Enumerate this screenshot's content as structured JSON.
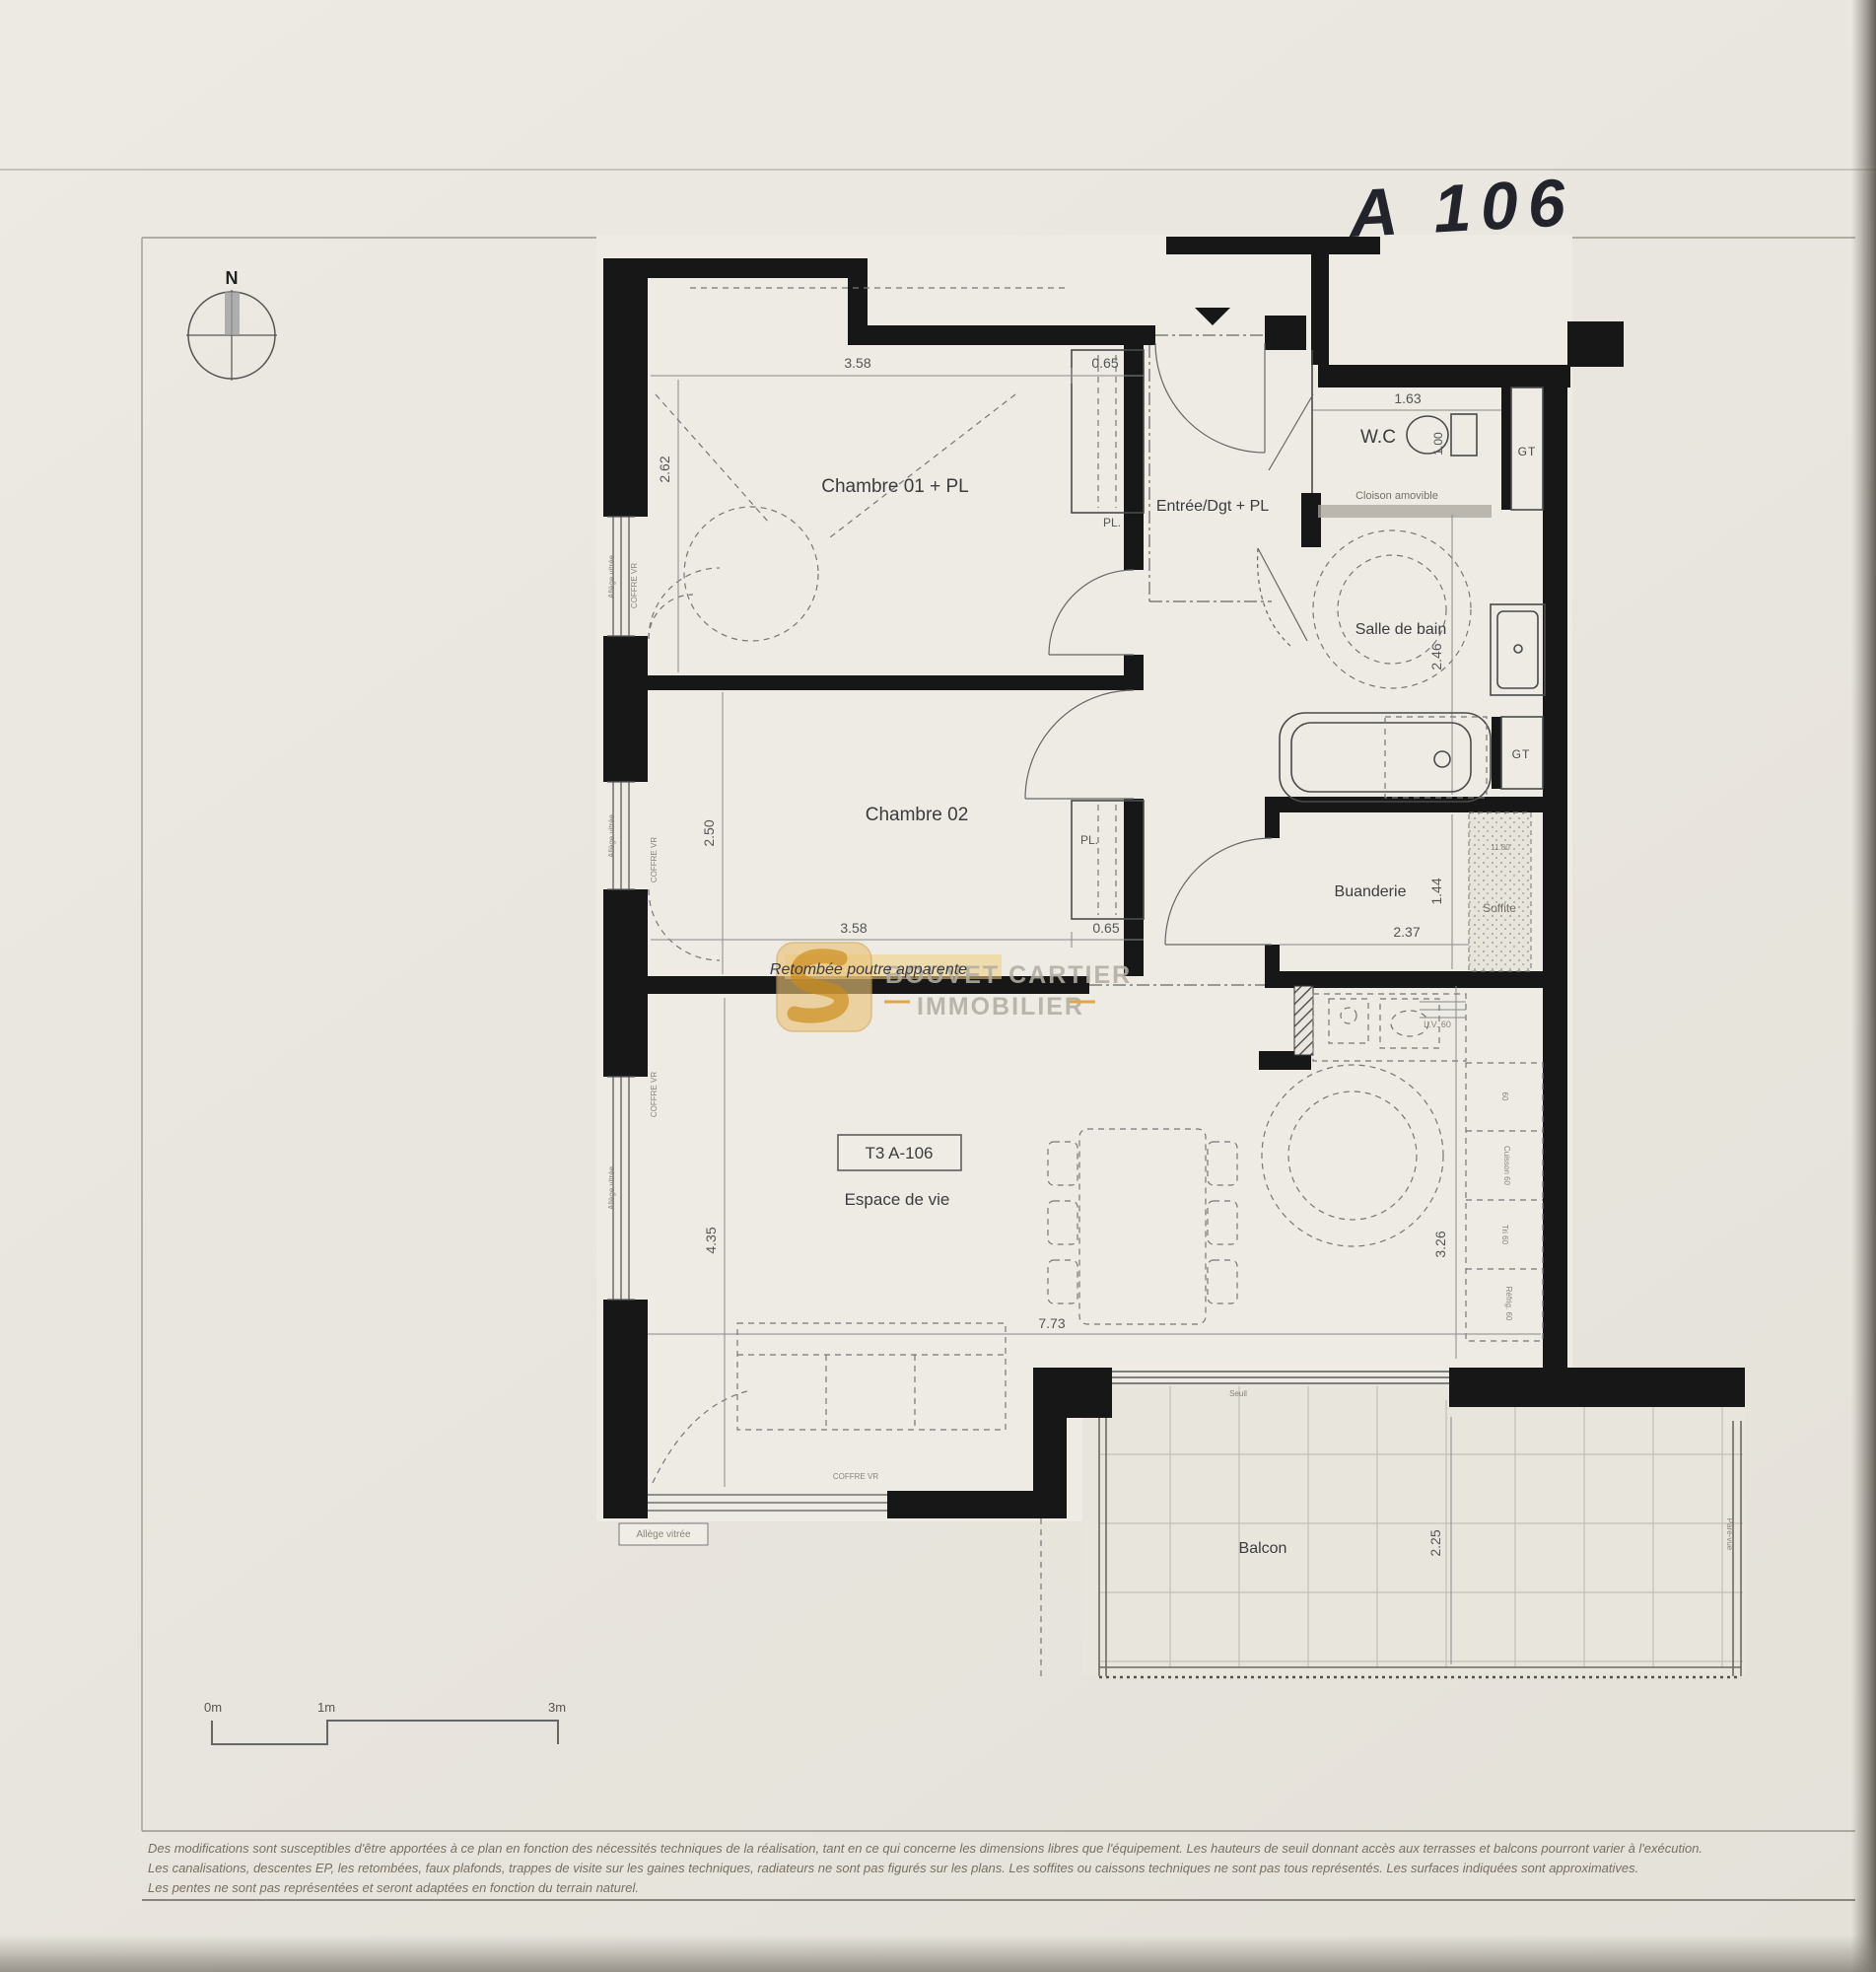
{
  "page": {
    "handwritten_label": "A 106",
    "compass": {
      "north": "N"
    },
    "watermark": {
      "line1": "BOUVET CARTIER",
      "line2": "IMMOBILIER"
    },
    "scale_bar": {
      "m0": "0m",
      "m1": "1m",
      "m3": "3m"
    },
    "footer": {
      "line1": "Des modifications sont susceptibles d'être apportées à ce plan en fonction des nécessités techniques de la réalisation, tant en ce qui concerne les dimensions libres que l'équipement. Les hauteurs de seuil donnant accès aux terrasses et balcons pourront varier à l'exécution.",
      "line2": "Les canalisations, descentes EP, les retombées, faux plafonds, trappes de visite sur les gaines techniques, radiateurs ne sont pas figurés sur les plans. Les soffites ou caissons techniques ne sont pas tous représentés. Les surfaces indiquées sont approximatives.",
      "line3": "Les pentes ne sont pas représentées et seront adaptées en fonction du terrain naturel."
    }
  },
  "plan": {
    "unit_label": "T3 A-106",
    "rooms": {
      "chambre01": "Chambre 01 + PL",
      "chambre02": "Chambre 02",
      "entree": "Entrée/Dgt + PL",
      "wc": "W.C",
      "salle_de_bain": "Salle de bain",
      "buanderie": "Buanderie",
      "soffite": "Soffite",
      "espace": "Espace de vie",
      "balcon": "Balcon"
    },
    "annotations": {
      "retombee": "Retombée poutre apparente",
      "cloison_amovible": "Cloison amovible",
      "seuil": "Seuil",
      "pare_vue": "Pare-vue",
      "pl": "PL.",
      "gt": "GT",
      "lave_vaisselle": "L.V. 60",
      "kitchen_60": "60",
      "kitchen_cuisson": "Cuisson 60",
      "kitchen_tri": "Tri 60",
      "kitchen_refrig": "Réfrig. 60",
      "allege_vitree": "Allège vitrée",
      "coffre_vr": "COFFRE VR",
      "soffite_dim": "11.80"
    },
    "dimensions": {
      "ch01_width": "3.58",
      "ch01_closet": "0.65",
      "ch01_height": "2.62",
      "wc_width": "1.63",
      "wc_depth": "1.00",
      "sdb_height": "2.46",
      "ch02_height": "2.50",
      "ch02_width": "3.58",
      "ch02_closet": "0.65",
      "buanderie_height": "1.44",
      "buanderie_width": "2.37",
      "espace_height": "4.35",
      "espace_width": "7.73",
      "kitchen_height": "3.26",
      "balcon_depth": "2.25"
    },
    "colors": {
      "accent_orange": "#d89a30",
      "highlight_yellow": "#f0d080",
      "wall_black": "#171717"
    }
  }
}
